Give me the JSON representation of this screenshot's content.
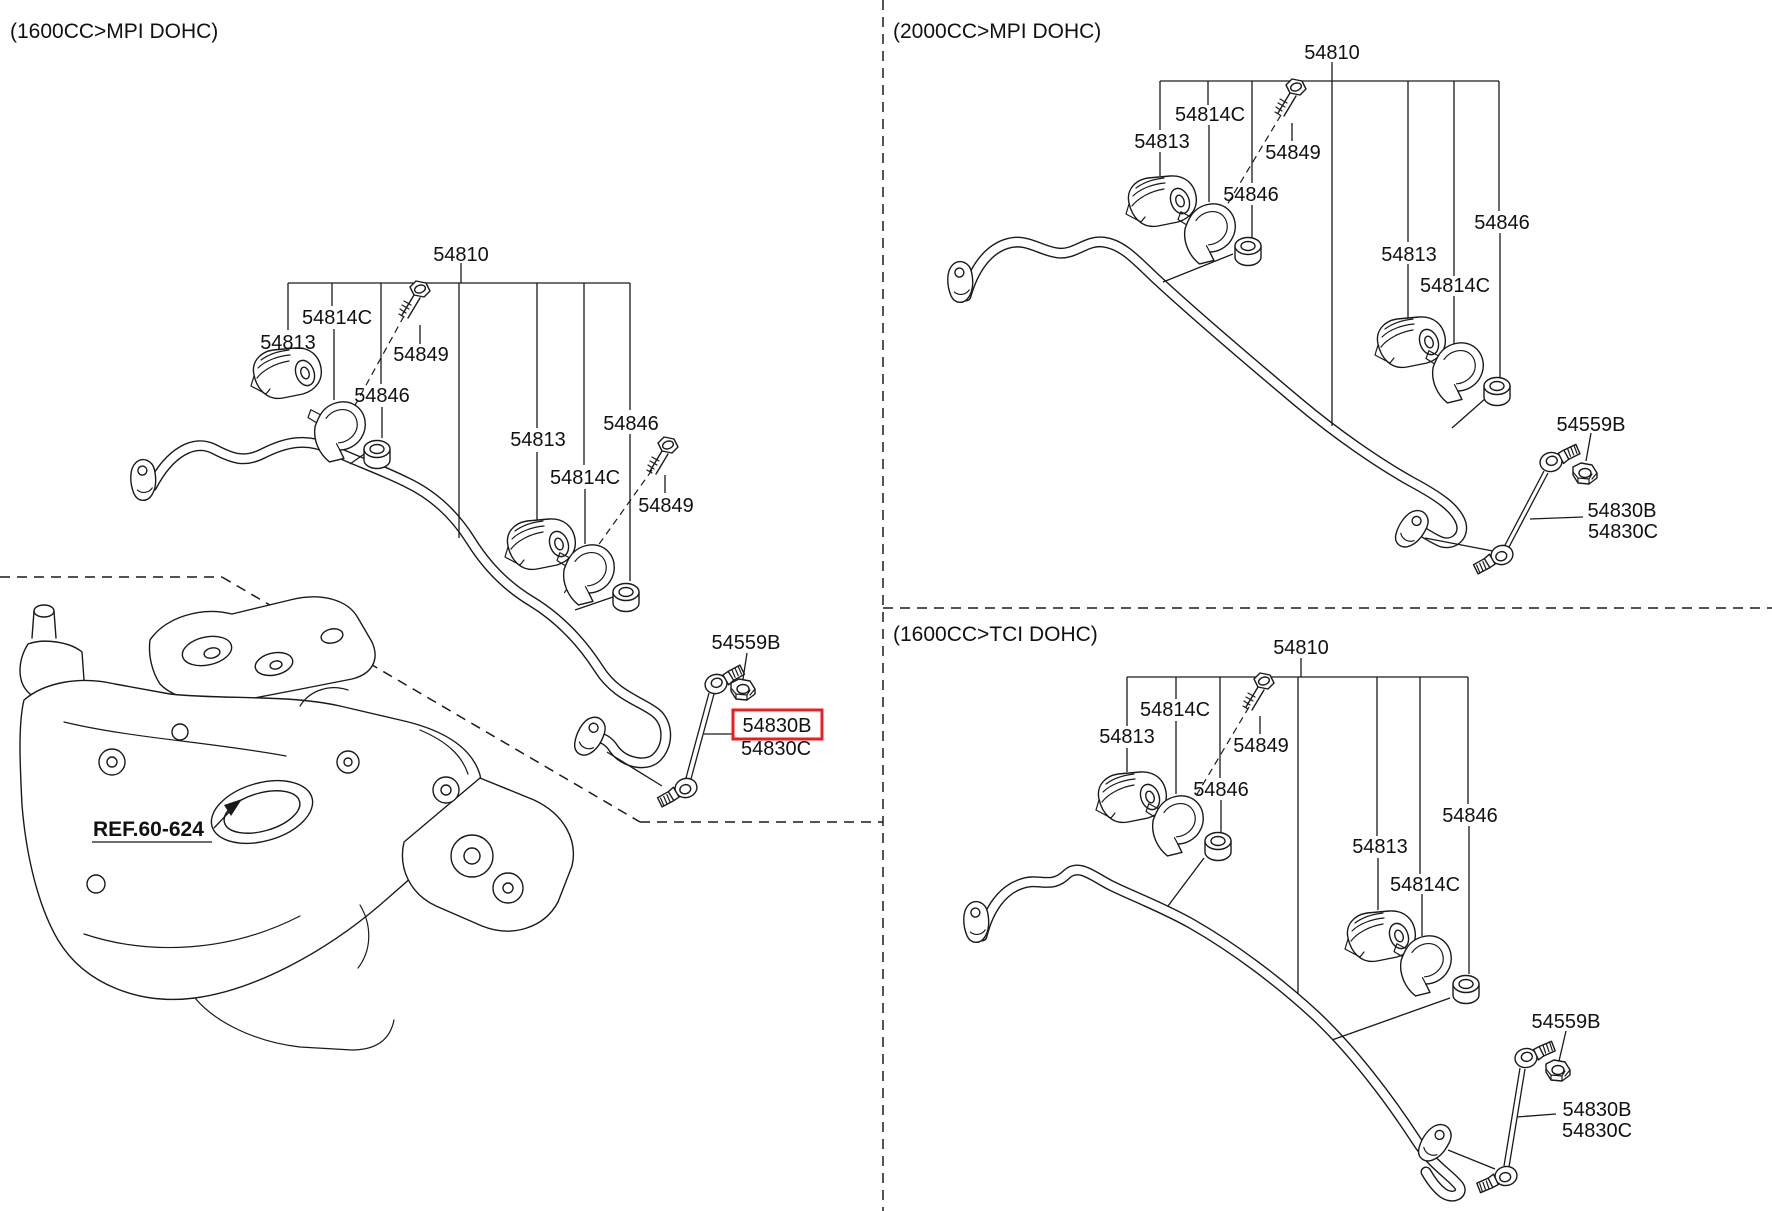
{
  "sections": {
    "left": {
      "header": "(1600CC>MPI DOHC)"
    },
    "topRight": {
      "header": "(2000CC>MPI DOHC)"
    },
    "bottomRight": {
      "header": "(1600CC>TCI DOHC)"
    }
  },
  "parts": {
    "stabilizer_bar": "54810",
    "bushing": "54813",
    "bush_bracket": "54814C",
    "bolt": "54849",
    "inner_bush": "54846",
    "link_nut": "54559B",
    "link": "54830B",
    "link_alt": "54830C"
  },
  "reference": {
    "label": "REF.60-624"
  },
  "highlight": {
    "part": "54830B",
    "box_color": "#ee1c1c"
  },
  "line_color": "#1a1a1a",
  "background": "#ffffff"
}
